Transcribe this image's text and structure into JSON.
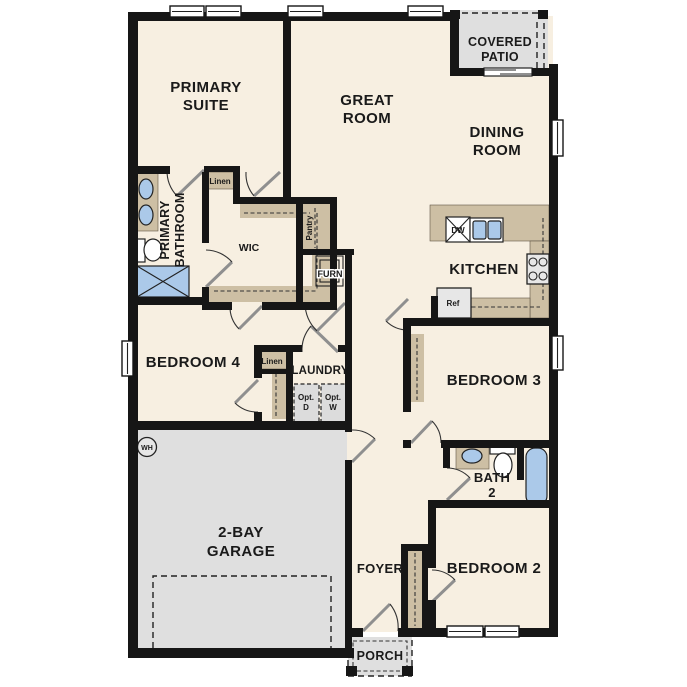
{
  "rooms": {
    "primary_suite": [
      "PRIMARY",
      "SUITE"
    ],
    "great_room": [
      "GREAT",
      "ROOM"
    ],
    "dining_room": [
      "DINING",
      "ROOM"
    ],
    "covered_patio": [
      "COVERED",
      "PATIO"
    ],
    "kitchen": "KITCHEN",
    "primary_bathroom": [
      "PRIMARY",
      "BATHROOM"
    ],
    "wic": "WIC",
    "pantry": "Pantry",
    "furnace_closet": "FURN",
    "bedroom4": "BEDROOM 4",
    "laundry": "LAUNDRY",
    "bedroom3": "BEDROOM 3",
    "bath2": [
      "BATH",
      "2"
    ],
    "bedroom2": "BEDROOM 2",
    "foyer": "FOYER",
    "garage": [
      "2-BAY",
      "GARAGE"
    ],
    "porch": "PORCH",
    "linen1": "Linen",
    "linen2": "Linen"
  },
  "fixtures": {
    "water_heater": "WH",
    "dishwasher": "DW",
    "refrigerator": "Ref",
    "opt_dryer": [
      "Opt.",
      "D"
    ],
    "opt_washer": [
      "Opt.",
      "W"
    ]
  },
  "colors": {
    "floor": "#f7efe1",
    "wall": "#161616",
    "cabinet_tan": "#cdbfa4",
    "concrete_gray": "#dfdfdf",
    "plumbing_blue": "#abc9e9"
  }
}
